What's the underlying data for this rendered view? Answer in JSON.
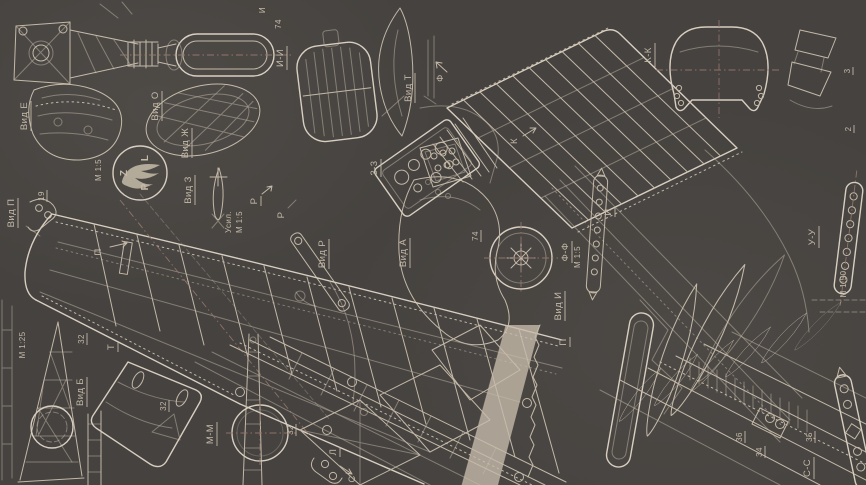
{
  "meta": {
    "description": "Scanned aircraft blueprint sheet (PZL fighter) with multiple sectional views and Cyrillic view labels",
    "background_color": "#45423f",
    "line_color": "#c3b8a7",
    "bright_line_color": "#d8cec0",
    "accent_dashline_color": "#93746a"
  },
  "logo": {
    "p": "P",
    "z": "Z",
    "l": "L"
  },
  "labels": {
    "ii": "И-И",
    "n74": "74",
    "i_top": "И",
    "vid_e": "Вид Е",
    "vid_o": "Вид О",
    "vid_zh": "Вид Ж",
    "m15_a": "М 1:5",
    "vid_p": "Вид П",
    "n19": "19",
    "vid_z": "Вид З",
    "usil": "Усил.",
    "m15_b": "М 1:5",
    "p_arrow": "П",
    "r_arrow": "Р",
    "r_arrow2": "Р",
    "vid_t": "Вид Т",
    "f_arrow": "Ф",
    "k_arrow": "К",
    "s33": "3-3",
    "kk": "К-К",
    "n3": "3",
    "n2": "2",
    "vid_r": "Вид Р",
    "vid_a": "Вид А",
    "n74b": "74",
    "ff": "Ф-Ф",
    "m15_c": "М 1:5",
    "vid_i": "Вид И",
    "p_small": "П",
    "i_small": "И",
    "uu": "У-У",
    "m150": "М 1:50",
    "m125": "М 1:25",
    "t_small": "Т",
    "n32a": "32",
    "vid_b": "Вид Б",
    "n32c": "32",
    "mm": "М-М",
    "n32b": "32",
    "l_small": "Л",
    "s_small": "С",
    "ss": "С-С",
    "n36": "36",
    "n34": "34",
    "n35": "35"
  }
}
